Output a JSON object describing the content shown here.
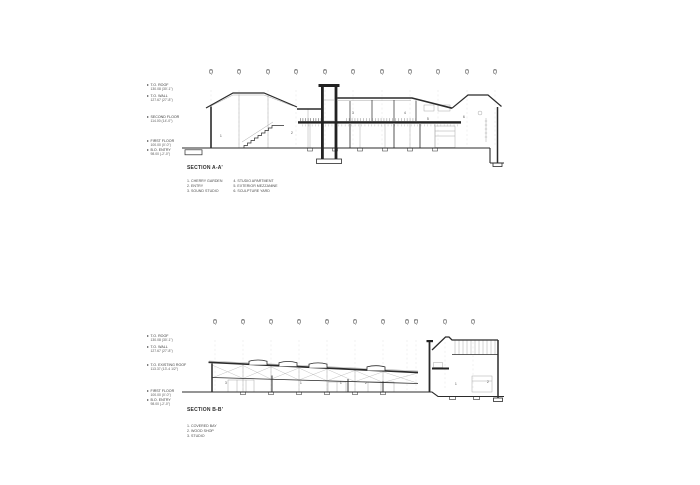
{
  "sheet": {
    "background": "#ffffff",
    "ink_color": "#2b2b2b",
    "light_line_color": "#a8a8a8"
  },
  "sections": [
    {
      "title": "SECTION A-A'",
      "grid_letters": [
        "A",
        "B",
        "C",
        "D",
        "E",
        "F",
        "G",
        "H",
        "I",
        "J",
        "K"
      ],
      "elevation_labels": [
        {
          "label": "T.O. ROOF",
          "value": "130.08 (30'-1\")"
        },
        {
          "label": "T.O. WALL",
          "value": "127.67 (27'-8\")"
        },
        {
          "label": "SECOND FLOOR",
          "value": "114.00 (14'-0\")"
        },
        {
          "label": "FIRST FLOOR",
          "value": "100.00 (0'-0\")"
        },
        {
          "label": "B.O. ENTRY",
          "value": "98.00 (-2'-0\")"
        }
      ],
      "legend_columns": [
        [
          "1. CHERRY GARDEN",
          "2. ENTRY",
          "3. SOUND STUDIO"
        ],
        [
          "4. STUDIO APARTMENT",
          "5. EXTERIOR MEZZANINE",
          "6. SCULPTURE YARD"
        ]
      ],
      "room_numbers": [
        "1",
        "2",
        "3",
        "4",
        "5",
        "6"
      ]
    },
    {
      "title": "SECTION B-B'",
      "grid_letters": [
        "A",
        "B",
        "C",
        "D",
        "E",
        "F",
        "G",
        "H",
        "H.1",
        "I",
        "J"
      ],
      "elevation_labels": [
        {
          "label": "T.O. ROOF",
          "value": "130.08 (30'-1\")"
        },
        {
          "label": "T.O. WALL",
          "value": "127.67 (27'-8\")"
        },
        {
          "label": "T.O. EXISTING ROOF",
          "value": "113.37 (13'-4 1/2\")"
        },
        {
          "label": "FIRST FLOOR",
          "value": "100.00 (0'-0\")"
        },
        {
          "label": "B.O. ENTRY",
          "value": "98.00 (-2'-0\")"
        }
      ],
      "legend_columns": [
        [
          "1. COVERED BAY",
          "2. WOOD SHOP",
          "3. STUDIO"
        ]
      ],
      "room_numbers": [
        "3",
        "1",
        "1",
        "2",
        "1",
        "2"
      ]
    }
  ]
}
